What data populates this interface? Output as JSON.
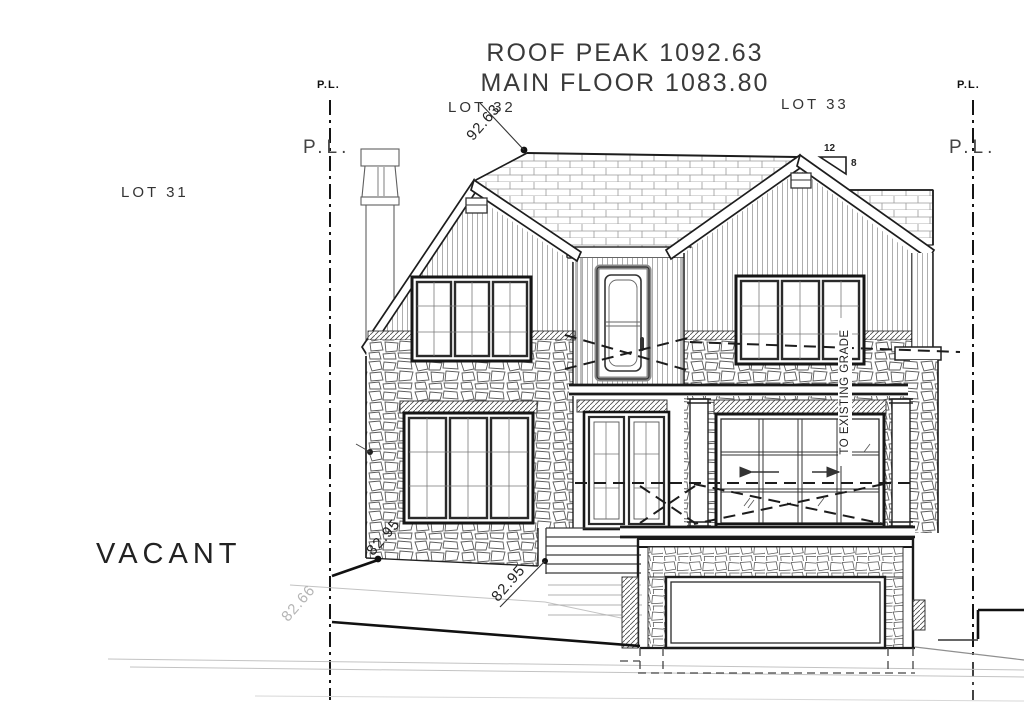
{
  "drawing": {
    "roof_peak_label": "ROOF PEAK 1092.63",
    "main_floor_label": "MAIN FLOOR 1083.80"
  },
  "lots": {
    "lot31": "LOT 31",
    "lot32": "LOT 32",
    "lot33": "LOT 33"
  },
  "property_lines": {
    "left_top": "P.L.",
    "left_mid": "P.L.",
    "right_top": "P.L.",
    "right_mid": "P.L."
  },
  "site": {
    "vacant": "VACANT"
  },
  "elevation_markers": {
    "roof_peak": "92.63",
    "grade_at_house_left": "82.95",
    "grade_at_steps": "82.95",
    "existing_grade": "82.66"
  },
  "notes": {
    "to_existing_grade": "TO EXISTING GRADE"
  },
  "roof_slope": {
    "rise": "12",
    "run": "8"
  },
  "colors": {
    "ink": "#1a1a1a",
    "light_grade": "#b5b5b5",
    "paper": "#ffffff"
  }
}
